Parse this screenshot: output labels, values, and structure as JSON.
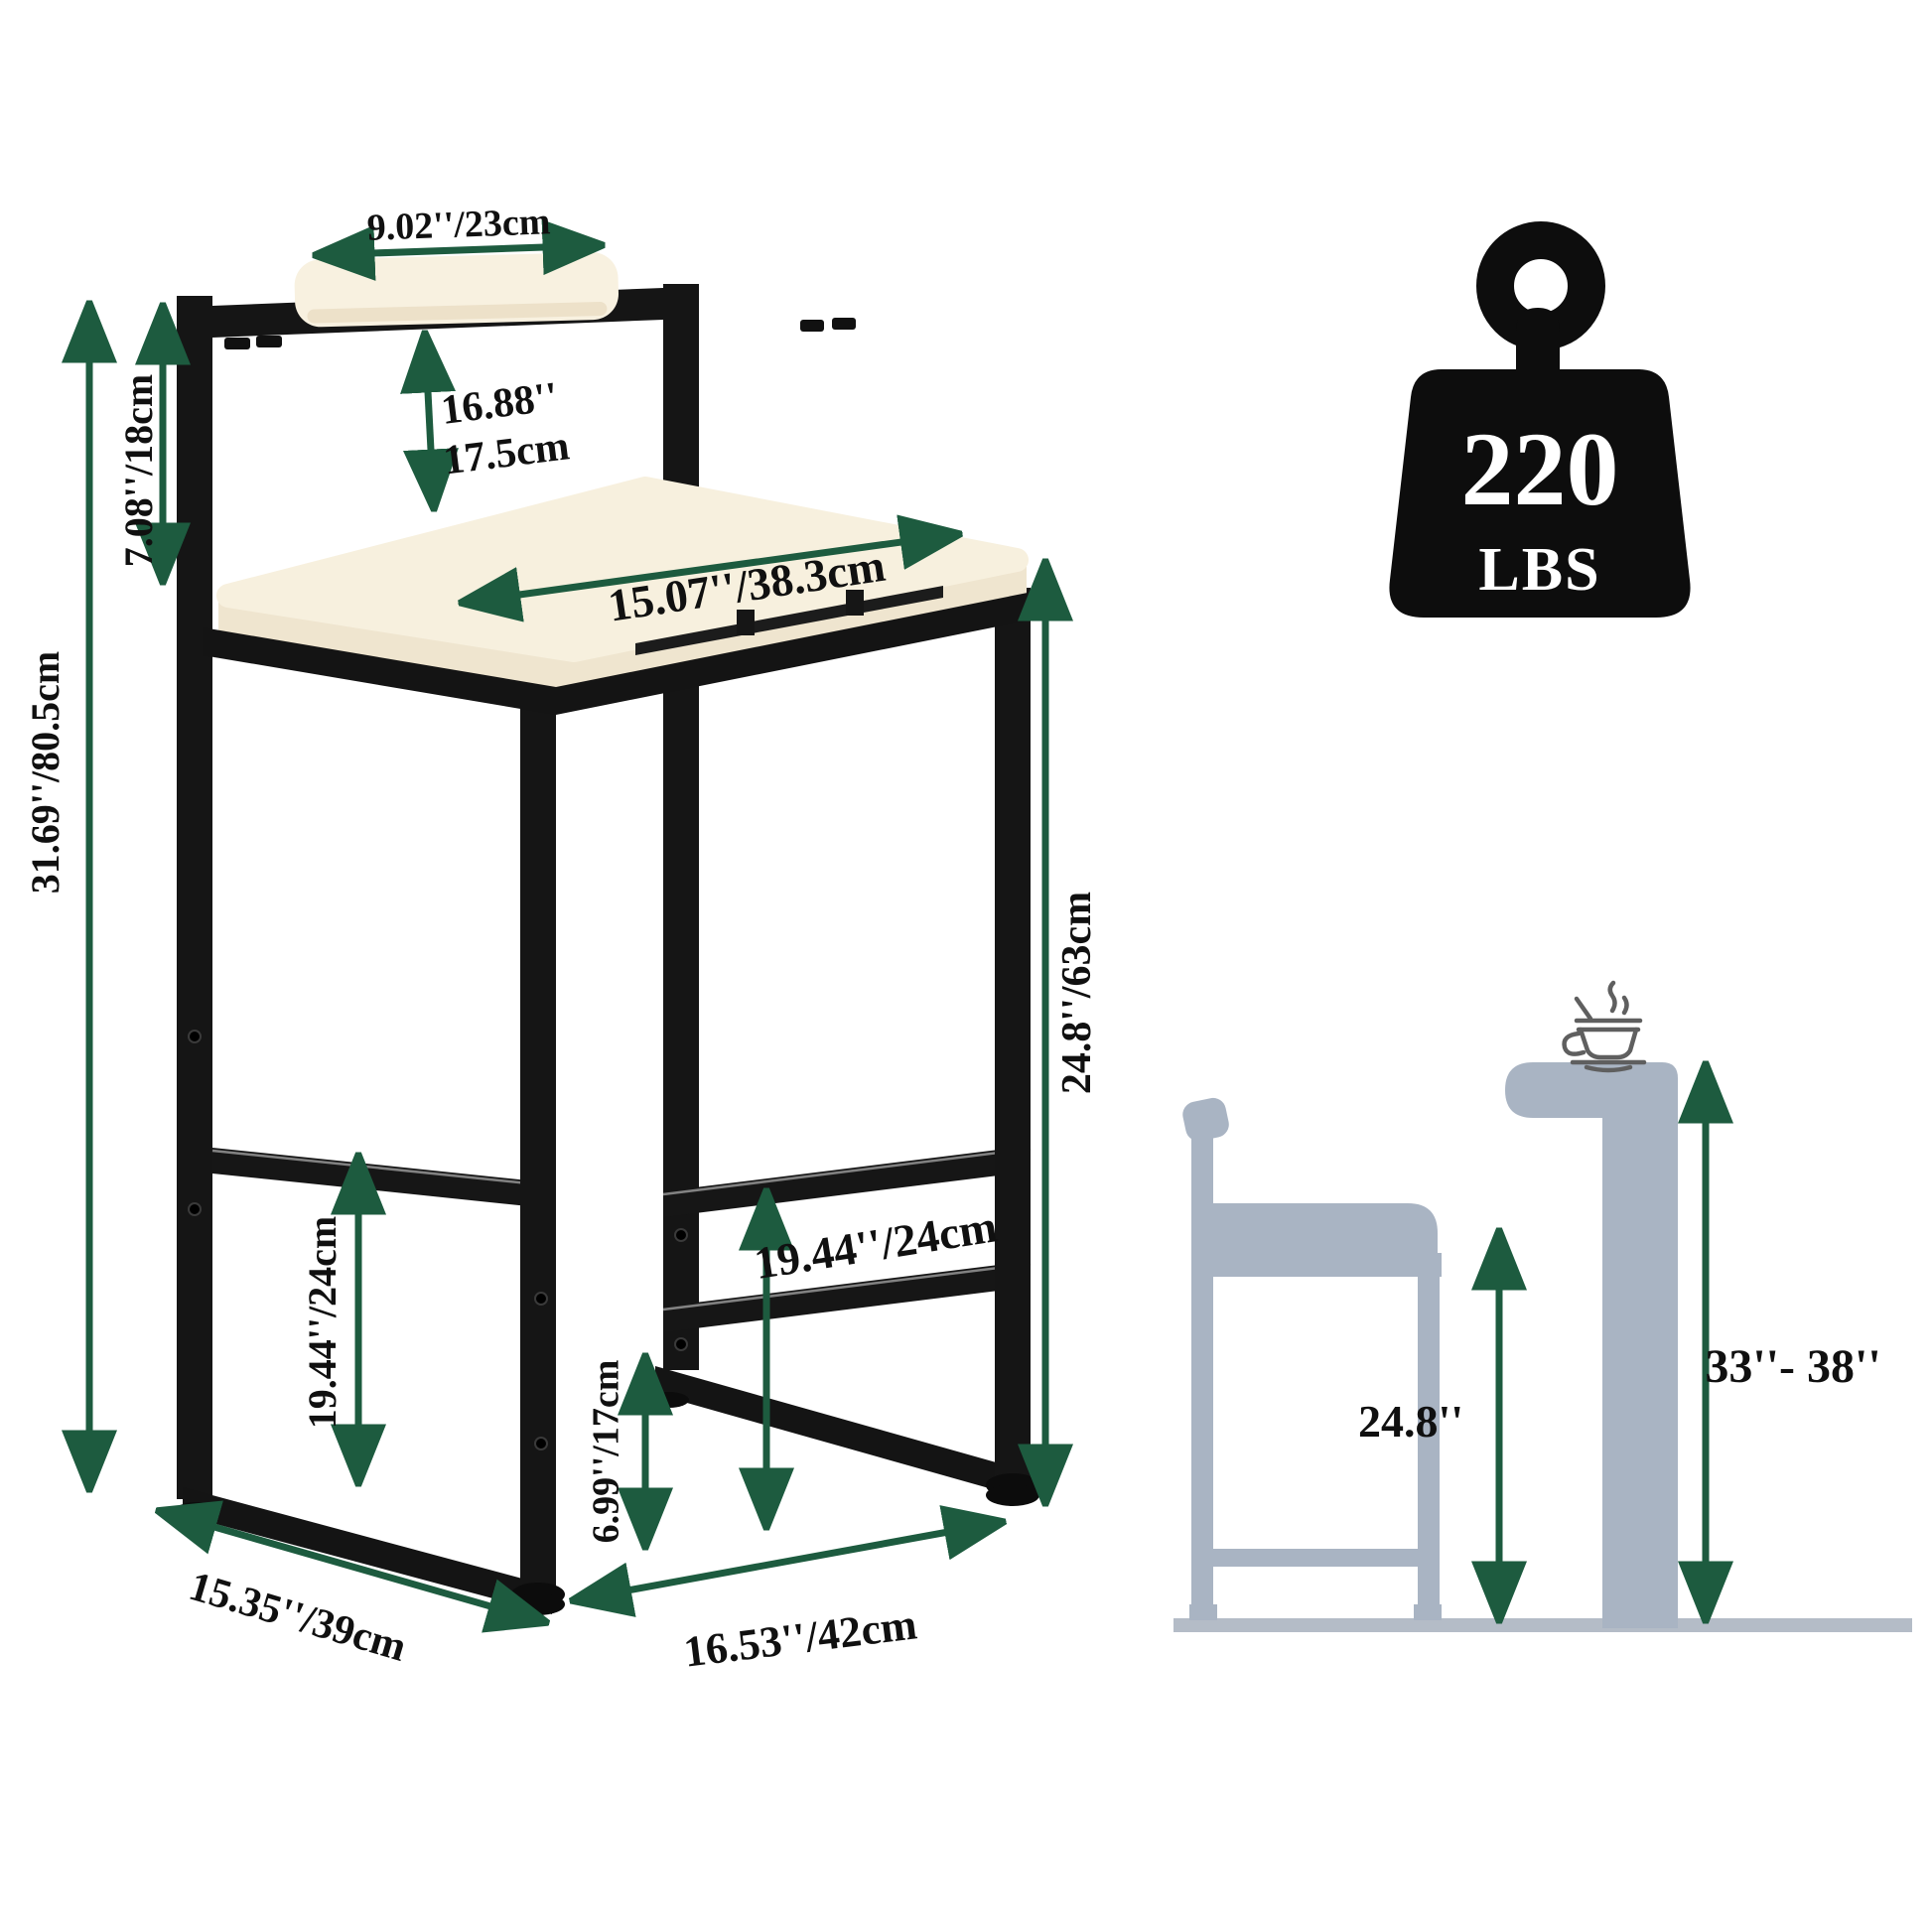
{
  "colors": {
    "arrow_green": "#1d5b3f",
    "frame_black": "#151515",
    "cushion_cream": "#f7f0de",
    "silhouette_gray": "#a9b4c3",
    "background": "#ffffff"
  },
  "weight_badge": {
    "value": "220",
    "unit": "LBS"
  },
  "front_view": {
    "backrest_width": "9.02''/23cm",
    "backrest_height": "7.08''/18cm",
    "backrest_to_seat_in": "16.88''",
    "backrest_to_seat_cm": "17.5cm",
    "seat_diagonal": "15.07''/38.3cm",
    "overall_height": "31.69''/80.5cm",
    "seat_height": "24.8''/63cm",
    "footrest_height_left": "19.44''/24cm",
    "footrest_height_right": "19.44''/24cm",
    "footrest_to_floor": "6.99''/17cm",
    "base_depth": "15.35''/39cm",
    "base_width": "16.53''/42cm"
  },
  "height_guide": {
    "stool_seat_height": "24.8''",
    "counter_height_range": "33''- 38''"
  }
}
